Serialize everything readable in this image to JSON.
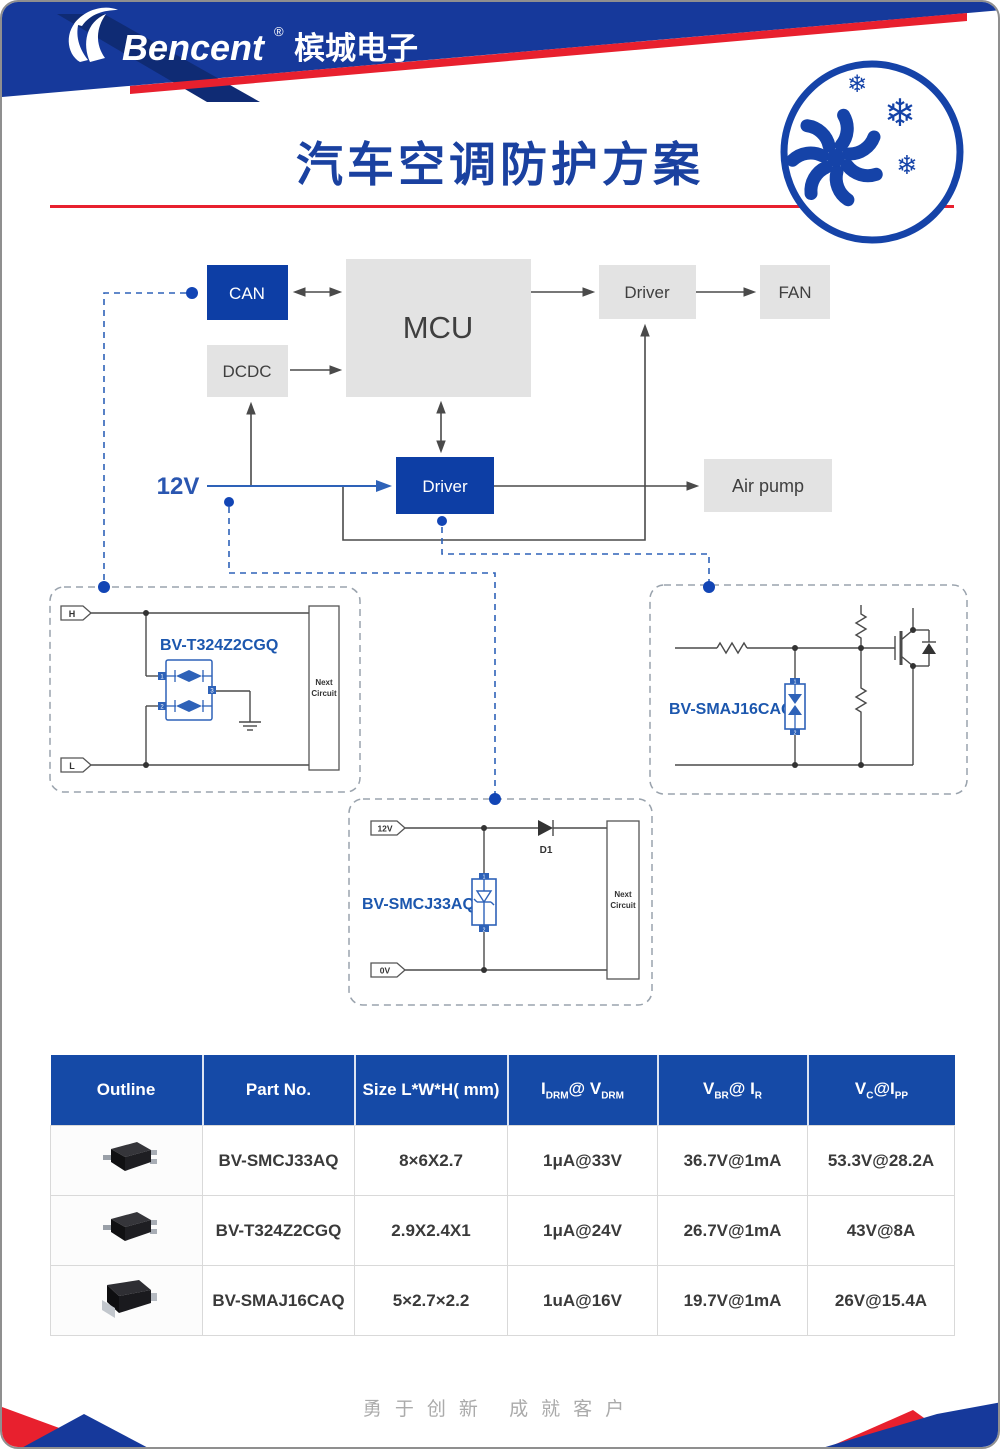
{
  "brand": {
    "name": "Bencent",
    "reg": "®",
    "cn": "槟城电子"
  },
  "title": "汽车空调防护方案",
  "blocks": {
    "can": "CAN",
    "dcdc": "DCDC",
    "mcu": "MCU",
    "driver_top": "Driver",
    "fan": "FAN",
    "driver_mid": "Driver",
    "air_pump": "Air pump",
    "supply": "12V"
  },
  "circuit_left": {
    "part": "BV-T324Z2CGQ",
    "tag_h": "H",
    "tag_l": "L",
    "pin1": "1",
    "pin2": "2",
    "pin3": "3",
    "next_line1": "Next",
    "next_line2": "Circuit"
  },
  "circuit_right": {
    "part": "BV-SMAJ16CAQ",
    "pin1": "1",
    "pin2": "2"
  },
  "circuit_bottom": {
    "part": "BV-SMCJ33AQ",
    "tag_top": "12V",
    "tag_bottom": "0V",
    "diode_label": "D1",
    "pin1": "1",
    "pin2": "2",
    "next_line1": "Next",
    "next_line2": "Circuit"
  },
  "table": {
    "headers": [
      {
        "text": "Outline"
      },
      {
        "text": "Part No."
      },
      {
        "text": "Size L*W*H( mm)"
      },
      {
        "p1": "I",
        "s1": "DRM",
        "p2": "@ V",
        "s2": "DRM"
      },
      {
        "p1": "V",
        "s1": "BR",
        "p2": "@ I",
        "s2": "R"
      },
      {
        "p1": "V",
        "s1": "C",
        "p2": "@I",
        "s2": "PP"
      }
    ],
    "rows": [
      {
        "part": "BV-SMCJ33AQ",
        "size": "8×6X2.7",
        "idrm": "1μA@33V",
        "vbr": "36.7V@1mA",
        "vc": "53.3V@28.2A"
      },
      {
        "part": "BV-T324Z2CGQ",
        "size": "2.9X2.4X1",
        "idrm": "1μA@24V",
        "vbr": "26.7V@1mA",
        "vc": "43V@8A"
      },
      {
        "part": "BV-SMAJ16CAQ",
        "size": "5×2.7×2.2",
        "idrm": "1uA@16V",
        "vbr": "19.7V@1mA",
        "vc": "26V@15.4A"
      }
    ]
  },
  "footer": {
    "slogan": "勇于创新    成就客户"
  },
  "colors": {
    "brand_blue": "#16399B",
    "deep_blue": "#0D3EA5",
    "navy": "#0F2B74",
    "red": "#E8202E",
    "gray_box": "#E3E3E3",
    "circuit_blue": "#2E62B8",
    "label_blue": "#1C57AE",
    "table_header_blue": "#154AA7",
    "dot_blue": "#1245B5"
  }
}
